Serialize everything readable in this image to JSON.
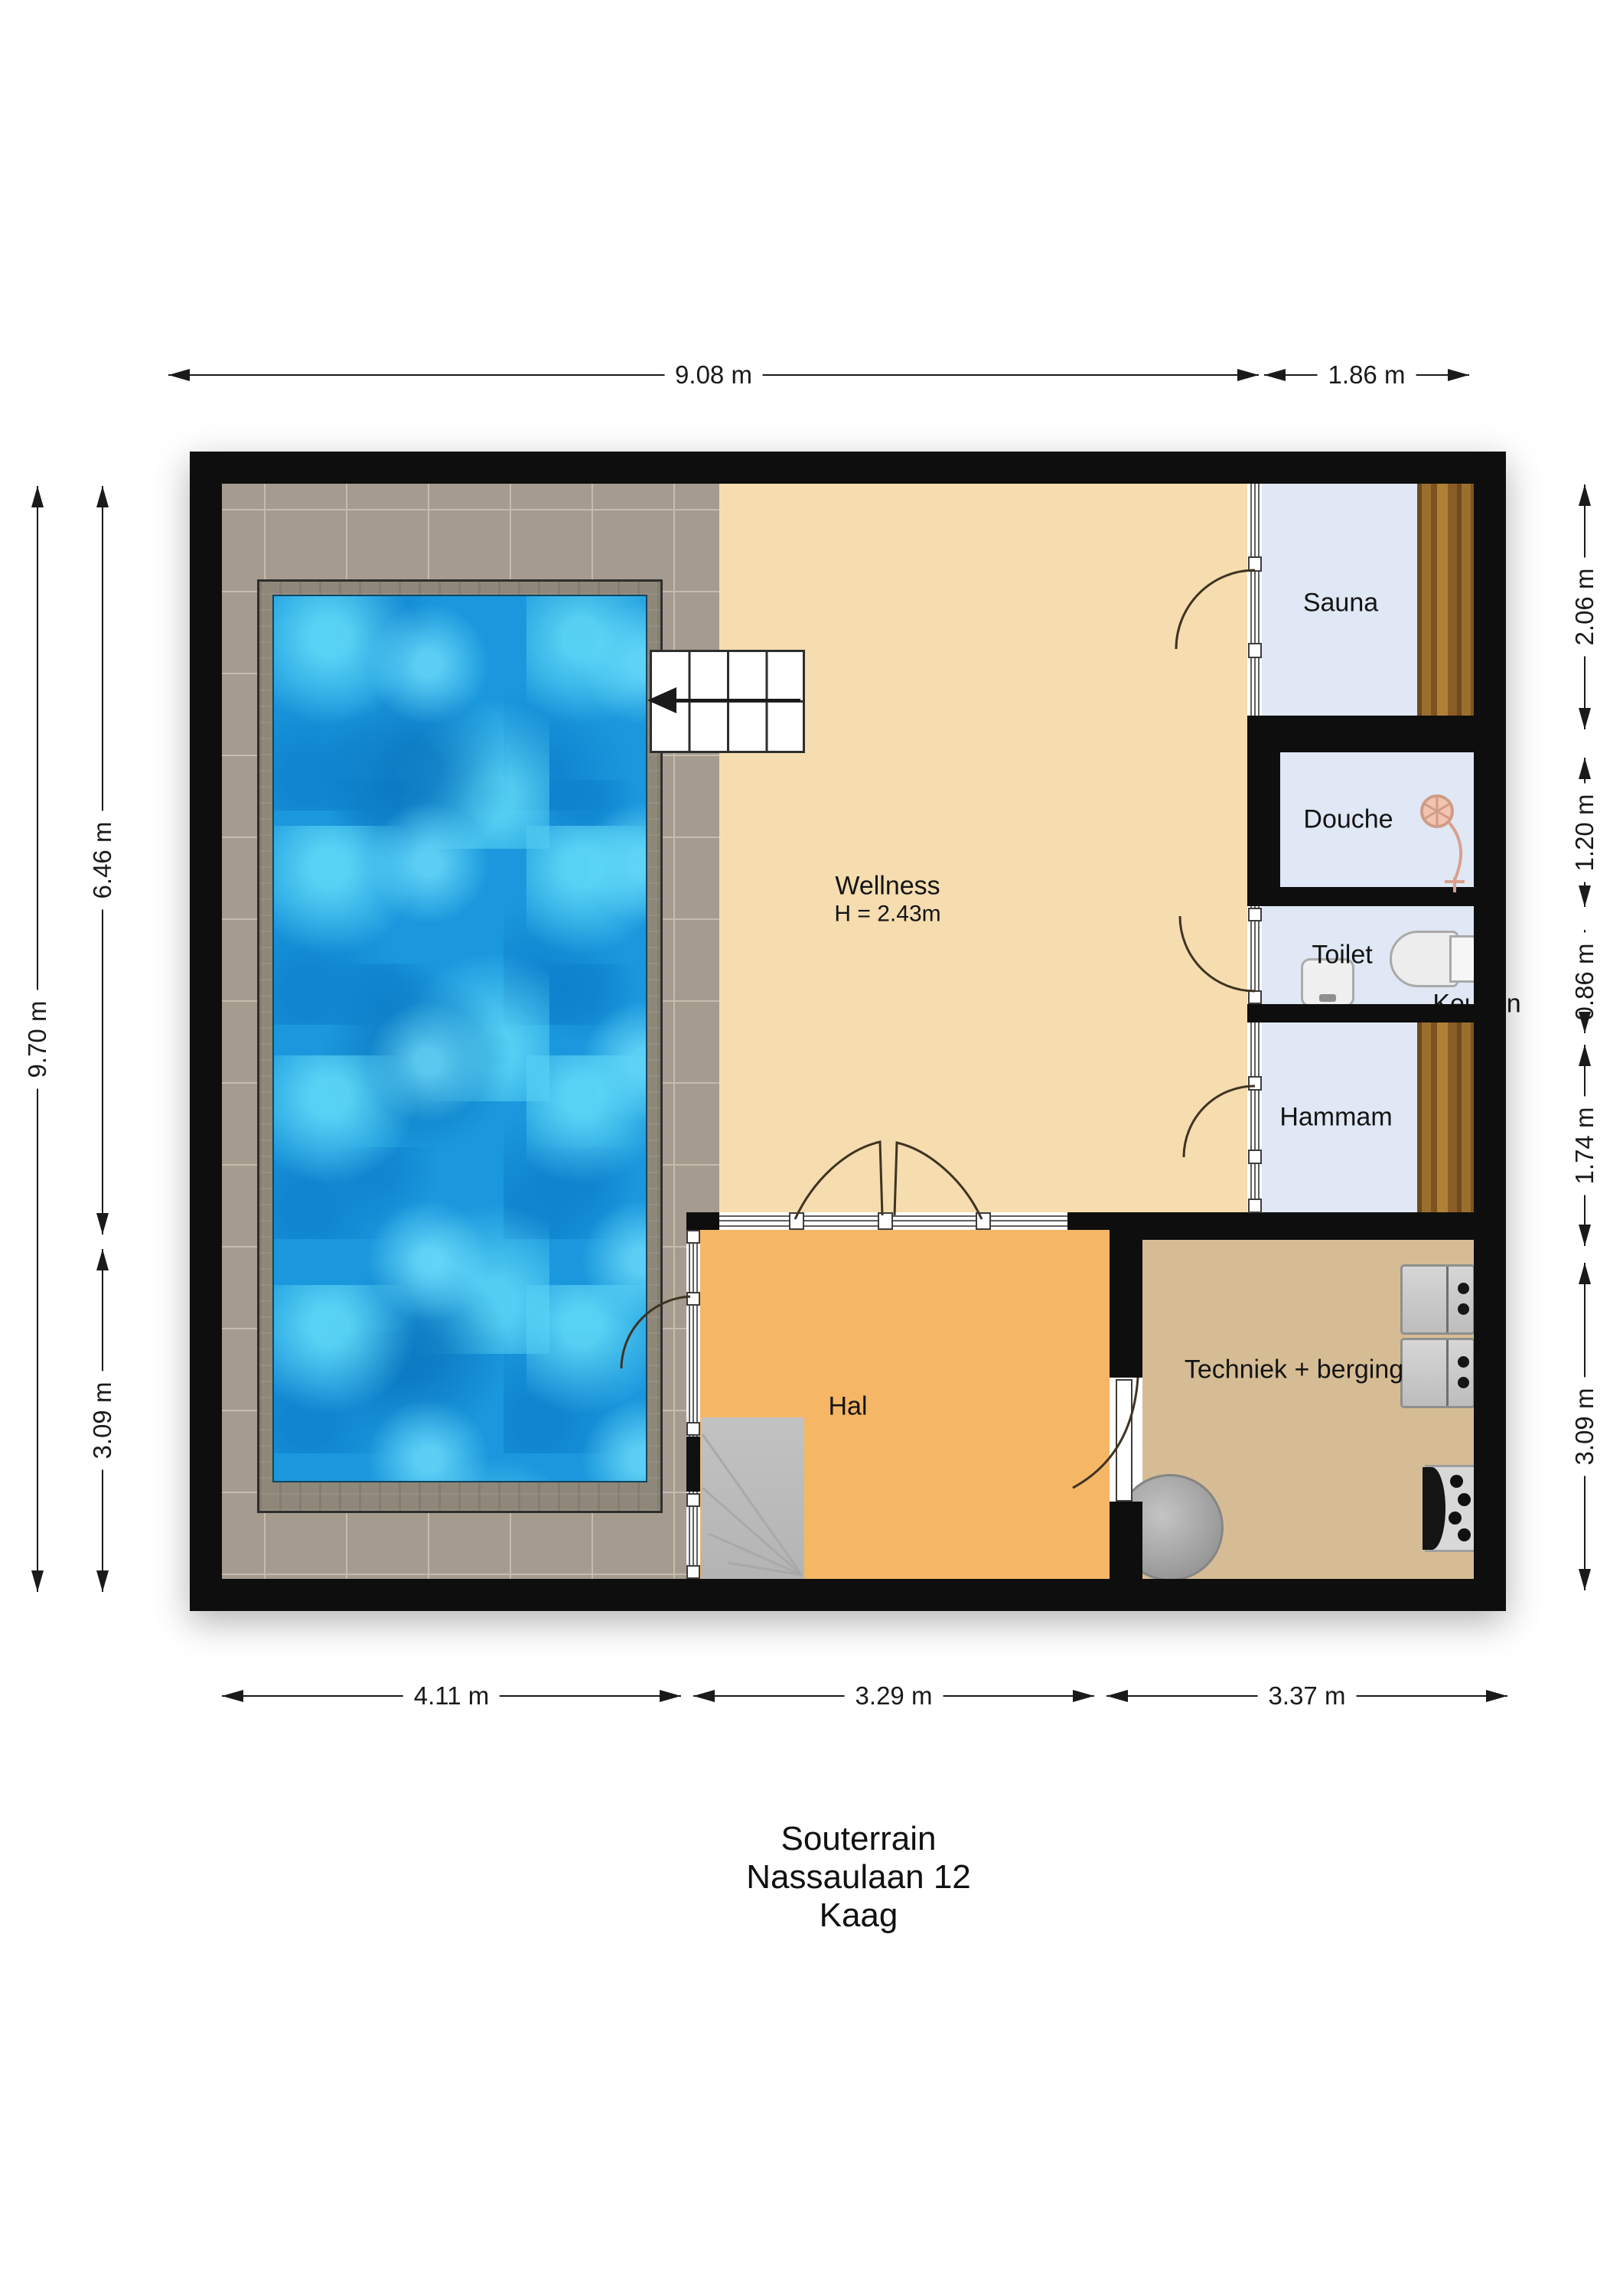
{
  "document": {
    "kind": "floor-plan",
    "floor_title": "Souterrain",
    "address_line": "Nassaulaan 12",
    "city": "Kaag"
  },
  "rooms": {
    "wellness": {
      "label": "Wellness",
      "height_note": "H = 2.43m"
    },
    "sauna": {
      "label": "Sauna"
    },
    "douche": {
      "label": "Douche"
    },
    "toilet": {
      "label": "Toilet"
    },
    "hammam": {
      "label": "Hammam"
    },
    "hal": {
      "label": "Hal"
    },
    "techniek": {
      "label": "Techniek + berging"
    },
    "clipped_label": {
      "label": "Keuken",
      "note": "partially hidden behind right wall"
    }
  },
  "dimensions": {
    "top": [
      "9.08 m",
      "1.86 m"
    ],
    "bottom": [
      "4.11 m",
      "3.29 m",
      "3.37 m"
    ],
    "left": [
      "9.70 m",
      "6.46 m",
      "3.09 m"
    ],
    "right": [
      "2.06 m",
      "1.20 m",
      "0.86 m",
      "1.74 m",
      "3.09 m"
    ]
  },
  "features": {
    "pool": "swimming pool with concrete surround",
    "stairs_up": "staircase with direction arrow (top)",
    "stairs_down": "winder staircase in hall",
    "appliances": [
      "washer",
      "dryer",
      "boiler tank",
      "heating manifold"
    ],
    "sanitary": [
      "shower head",
      "toilet",
      "hand basin"
    ],
    "benches": [
      "sauna bench",
      "hammam bench"
    ]
  },
  "colors": {
    "wall": "#0e0e0e",
    "wellness_floor": "#f5ddb0",
    "hall_floor": "#f5b766",
    "tech_floor": "#d6bc95",
    "room_floor": "#dfe8f4",
    "tile_floor": "#a59b8f",
    "pool_water": "#1b98dd",
    "pool_caustic": "#62dcf8",
    "concrete": "#8f8779",
    "wood_bench": "#9a6f2e",
    "stair_grey": "#bdbdbd",
    "dimension_ink": "#1a1a1a"
  }
}
